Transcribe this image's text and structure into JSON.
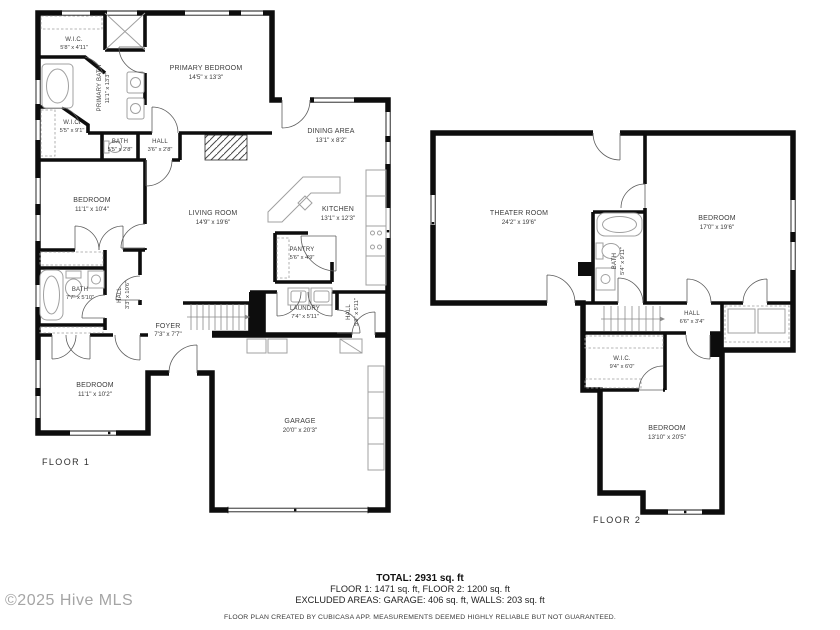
{
  "watermark": "©2025 Hive MLS",
  "summary": {
    "total": "TOTAL: 2931 sq. ft",
    "floors": "FLOOR 1: 1471 sq. ft, FLOOR 2: 1200 sq. ft",
    "excluded": "EXCLUDED AREAS: GARAGE: 406 sq. ft, WALLS: 203 sq. ft",
    "disclaimer": "FLOOR PLAN CREATED BY CUBICASA APP. MEASUREMENTS DEEMED HIGHLY RELIABLE BUT NOT GUARANTEED."
  },
  "colors": {
    "wall": "#0d0d0d",
    "fixture": "#a0a0a0",
    "text": "#3c3c3c",
    "watermark": "#a5a5a5"
  },
  "floor1": {
    "label": "FLOOR 1",
    "rooms": {
      "wic1": {
        "name": "W.I.C.",
        "dims": "5'8\" x 4'11\""
      },
      "primary_bath": {
        "name": "PRIMARY BATH",
        "dims": "11'1\" x 13'3\""
      },
      "primary_bedroom": {
        "name": "PRIMARY BEDROOM",
        "dims": "14'5\" x 13'3\""
      },
      "wic2": {
        "name": "W.I.C.",
        "dims": "5'5\" x 9'1\""
      },
      "bath_small": {
        "name": "BATH",
        "dims": "5'5\" x 2'8\""
      },
      "hall_small": {
        "name": "HALL",
        "dims": "3'6\" x 2'8\""
      },
      "dining": {
        "name": "DINING AREA",
        "dims": "13'1\" x 8'2\""
      },
      "bedroom1": {
        "name": "BEDROOM",
        "dims": "11'1\" x 10'4\""
      },
      "living": {
        "name": "LIVING ROOM",
        "dims": "14'9\" x 19'6\""
      },
      "kitchen": {
        "name": "KITCHEN",
        "dims": "13'1\" x 12'3\""
      },
      "pantry": {
        "name": "PANTRY",
        "dims": "5'6\" x 4'9\""
      },
      "bath2": {
        "name": "BATH",
        "dims": "7'7\" x 5'10\""
      },
      "hall2": {
        "name": "HALL",
        "dims": "3'3\" x 10'6\""
      },
      "foyer": {
        "name": "FOYER",
        "dims": "7'3\" x 7'7\""
      },
      "laundry": {
        "name": "LAUNDRY",
        "dims": "7'4\" x 5'11\""
      },
      "hall3": {
        "name": "HALL",
        "dims": "5'9\" x 5'11\""
      },
      "bedroom2": {
        "name": "BEDROOM",
        "dims": "11'1\" x 10'2\""
      },
      "garage": {
        "name": "GARAGE",
        "dims": "20'0\" x 20'3\""
      }
    }
  },
  "floor2": {
    "label": "FLOOR 2",
    "rooms": {
      "theater": {
        "name": "THEATER ROOM",
        "dims": "24'2\" x 19'6\""
      },
      "bedroom3": {
        "name": "BEDROOM",
        "dims": "17'0\" x 19'6\""
      },
      "bath3": {
        "name": "BATH",
        "dims": "5'4\" x 9'11\""
      },
      "hall4": {
        "name": "HALL",
        "dims": "6'6\" x 3'4\""
      },
      "wic3": {
        "name": "W.I.C.",
        "dims": "9'4\" x 6'0\""
      },
      "bedroom4": {
        "name": "BEDROOM",
        "dims": "13'10\" x 20'5\""
      }
    }
  }
}
